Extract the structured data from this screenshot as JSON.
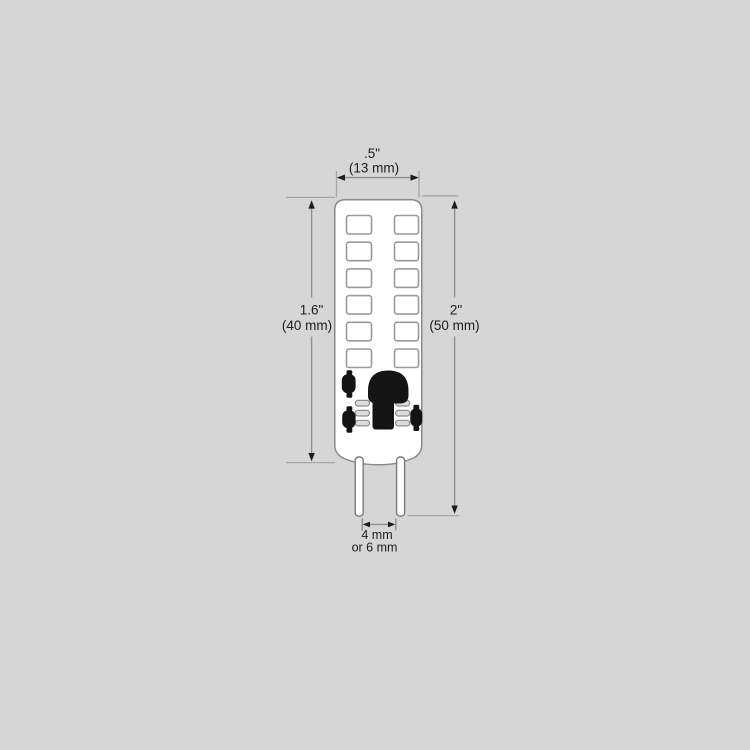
{
  "canvas": {
    "background_color": "#d6d6d6",
    "figure": "g4-led-bi-pin-bulb-dimension-diagram"
  },
  "bulb": {
    "led_chip_rows": 6,
    "led_chip_columns": 2,
    "led_chip_count": 12,
    "pin_count": 2,
    "colors": {
      "body_fill": "#ffffff",
      "outline_gray": "#8a8a8a",
      "component_black": "#141414",
      "dimension_line_gray": "#8f8f8f",
      "extension_line_gray": "#a6a6a6",
      "text_color": "#1c1c1c"
    }
  },
  "dimensions": {
    "width": {
      "inches": ".5\"",
      "metric": "(13 mm)"
    },
    "body_height": {
      "inches": "1.6\"",
      "metric": "(40 mm)"
    },
    "overall_height": {
      "inches": "2\"",
      "metric": "(50 mm)"
    },
    "pin_spacing": {
      "primary": "4 mm",
      "alternate": "or 6 mm"
    }
  }
}
